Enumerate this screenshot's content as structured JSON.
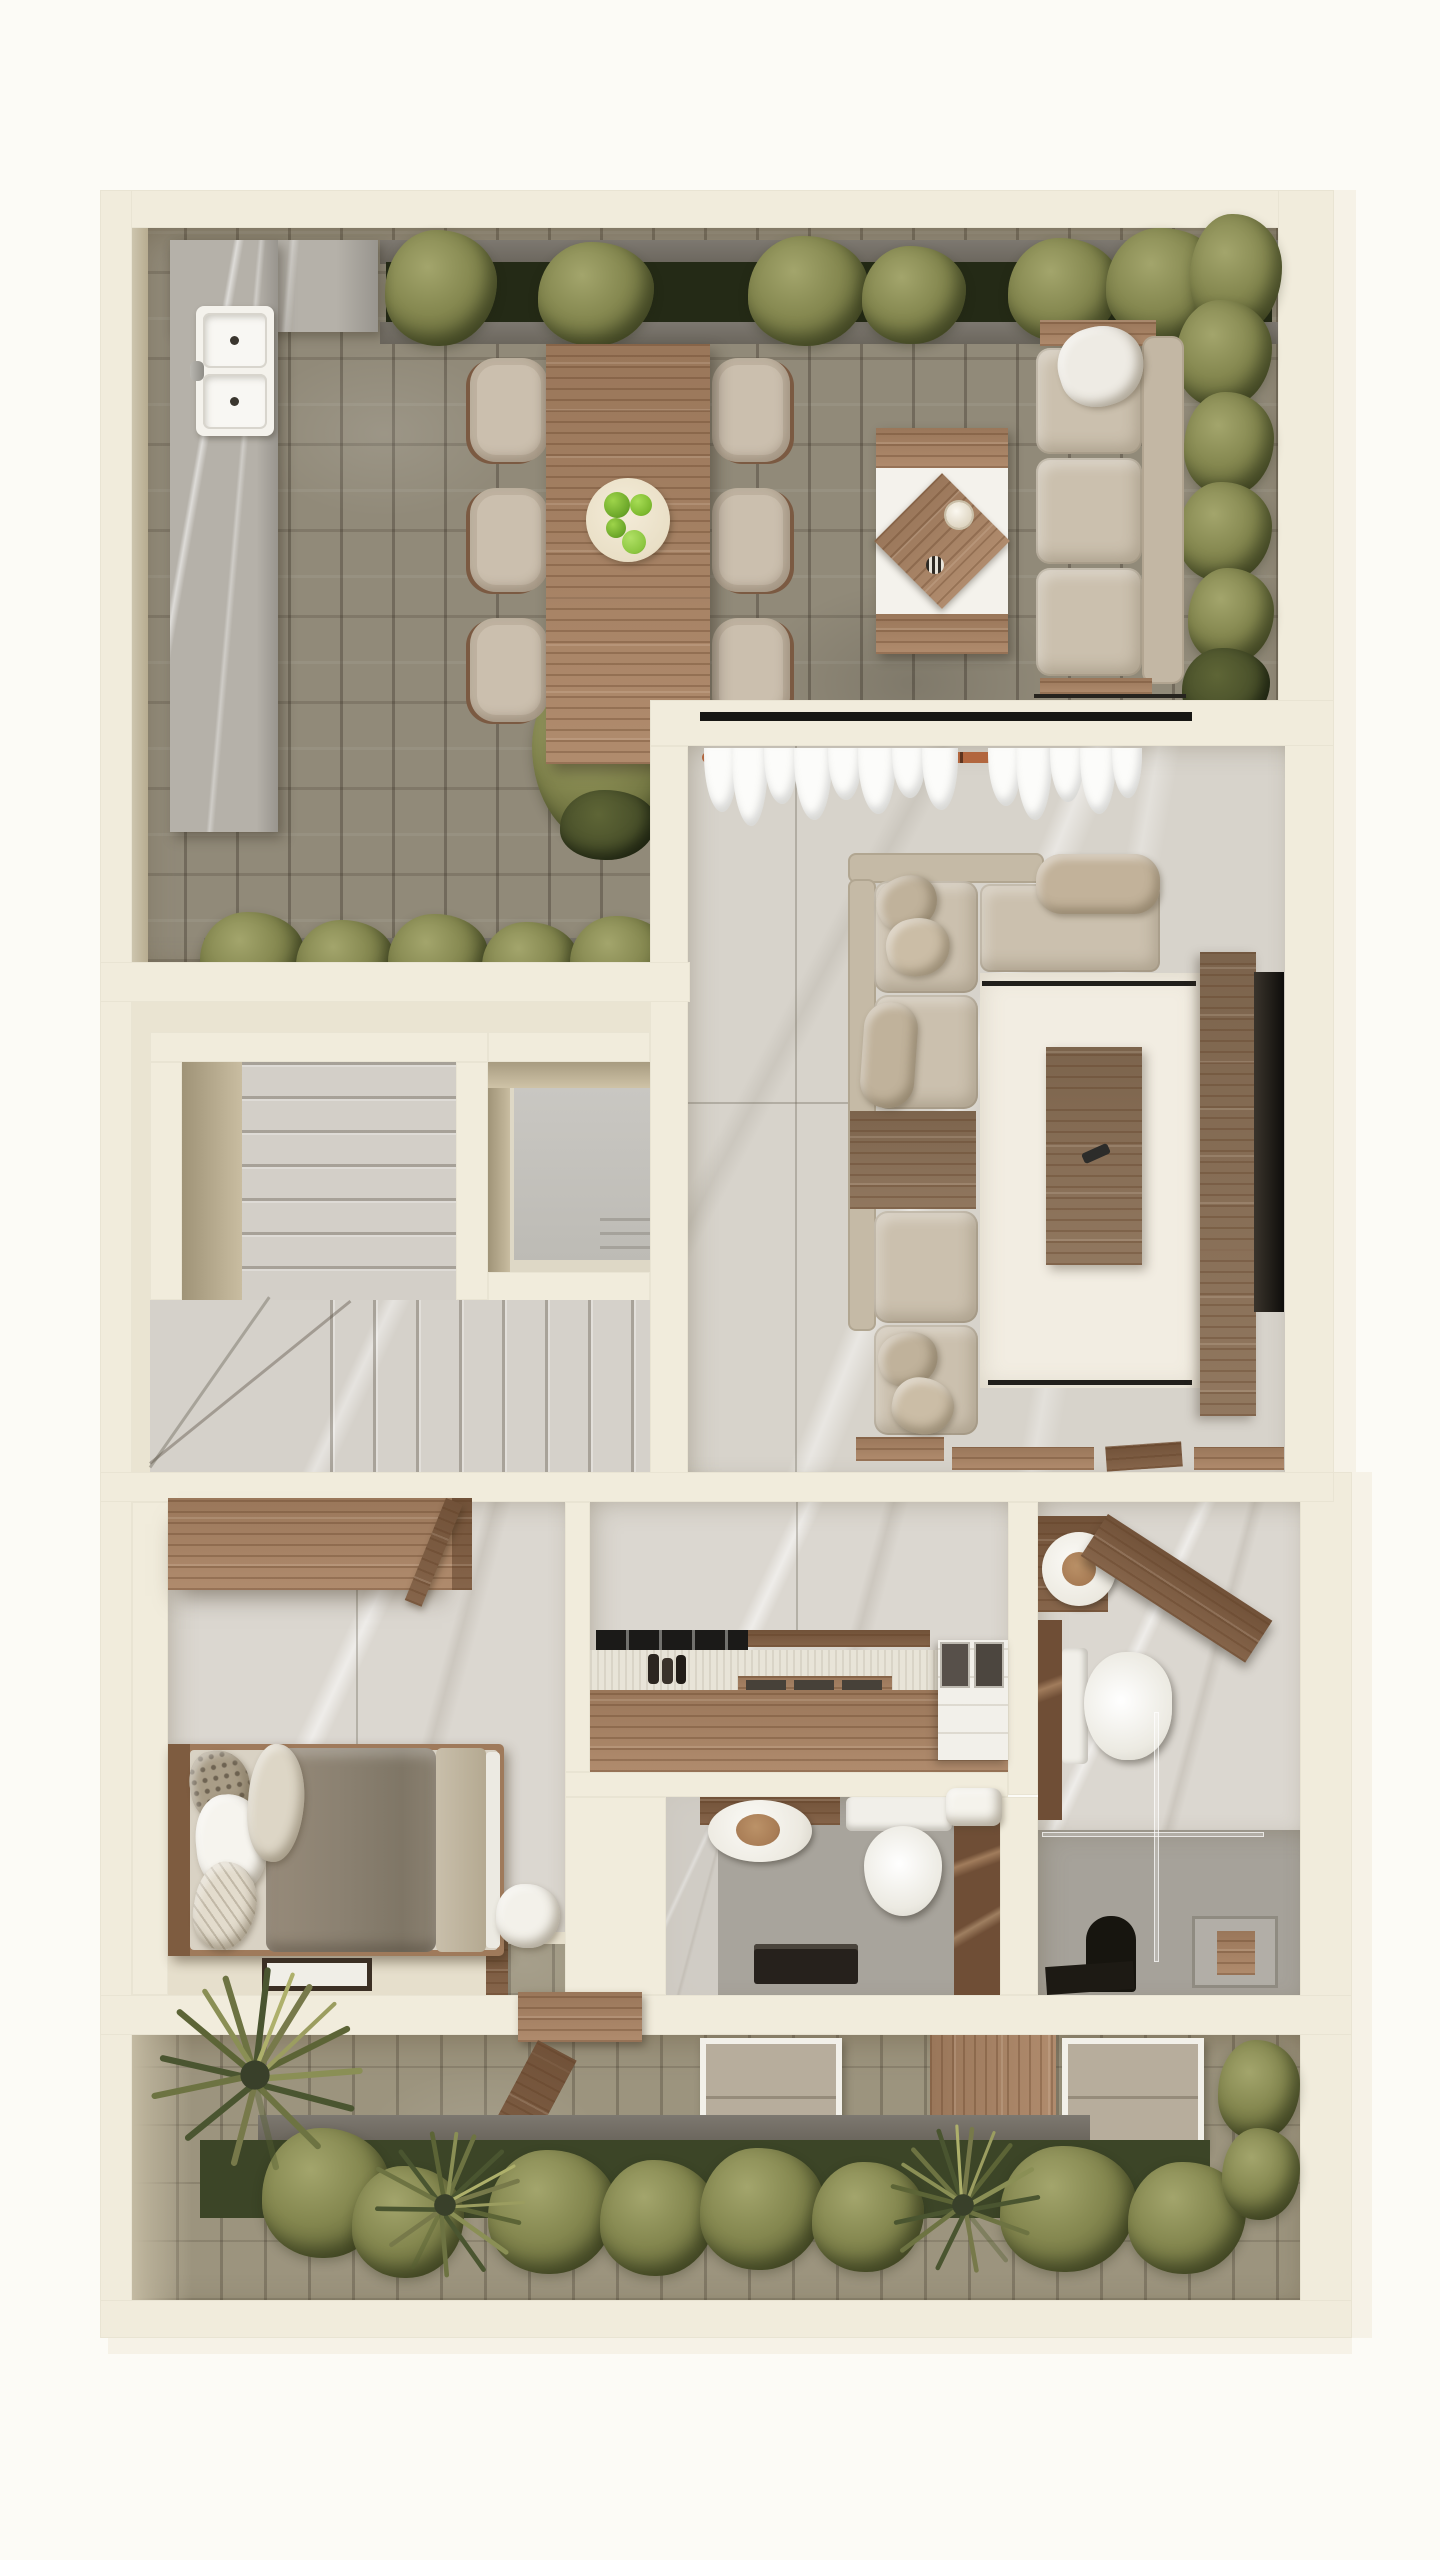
{
  "meta": {
    "title": "3D Floor Plan — Top-Down Architectural Render",
    "type": "photorealistic top-view floor plan, no visible text",
    "canvas": {
      "width": 1440,
      "height": 2560
    }
  },
  "palette": {
    "background": "#fcfbf6",
    "wall": "#f1ecdc",
    "wall_outer_face": "#f6f2e7",
    "wall_inner_shade": "#b0a489",
    "terrace_stone": "#918a79",
    "garden_stone": "#9c947e",
    "interior_marble": "#d7d3cb",
    "wall_slab_marble": "#dbd7d0",
    "counter_marble": "#b5b1a9",
    "wood": "#ab8464",
    "wood_dark": "#7e5b3f",
    "walnut": "#8a6f55",
    "upholstery": "#cbc0ae",
    "rug": "#f2ede2",
    "tv_screen": "#2b2824",
    "foliage": "#84874f",
    "foliage_dark": "#39402a",
    "planter_soil": "#242a16",
    "porcelain": "#f4f2ec",
    "brown_marble": "#6f4e36",
    "wet_floor": "#a8a49c",
    "black_fixture": "#1c1914"
  },
  "rooms": {
    "terrace": {
      "name": "Rooftop terrace with outdoor dining",
      "items": [
        "planter hedge",
        "outdoor kitchen counter",
        "double sink",
        "dining table for six",
        "fruit plate with green apples",
        "outdoor coffee table",
        "outdoor sofa",
        "olive tree",
        "boxwood hedge"
      ]
    },
    "living": {
      "name": "Living room",
      "items": [
        "window wall",
        "curtain rod",
        "sheer curtains",
        "sectional sofa",
        "throw pillows",
        "built-in side table",
        "area rug",
        "coffee table",
        "remote control",
        "media console",
        "wall TV"
      ]
    },
    "stairs": {
      "name": "Staircase hall",
      "items": [
        "upper stair flight",
        "stair void",
        "main staircase"
      ]
    },
    "bedroom": {
      "name": "Bedroom",
      "items": [
        "wardrobe",
        "open door leaf",
        "single bed",
        "patterned pillows",
        "floor tray",
        "garden threshold"
      ]
    },
    "kitchen": {
      "name": "Kitchen",
      "items": [
        "stone wall panels",
        "gas cooktop",
        "spice jars",
        "serving tray with mats",
        "timber base cabinet",
        "island unit with trays"
      ]
    },
    "powder": {
      "name": "Guest toilet",
      "items": [
        "round basin on timber shelf",
        "toilet",
        "stone partition",
        "towel",
        "black bench"
      ]
    },
    "bath": {
      "name": "Bathroom",
      "items": [
        "round basin",
        "angled timber shelf",
        "toilet",
        "stone partition",
        "walk-in shower",
        "black shower column",
        "towel ladder rack"
      ]
    },
    "garden": {
      "name": "Backyard garden",
      "items": [
        "sun lounger",
        "timber deck",
        "sun lounger",
        "open garden door",
        "shrub border",
        "ornamental grasses",
        "stone paving"
      ]
    }
  }
}
